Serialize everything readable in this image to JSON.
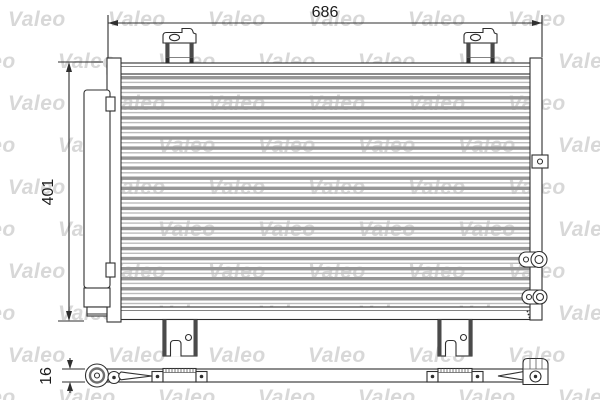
{
  "watermark": {
    "text": "Valeo",
    "color": "#d8d8d8"
  },
  "dimensions": {
    "width_mm": "686",
    "height_mm": "401",
    "depth_mm": "16"
  },
  "drawing": {
    "subject": "condenser-technical-drawing",
    "core_tube_rows": 23,
    "stroke_color": "#2f2f2f",
    "tube_band_color": "#979797",
    "tube_line_color": "#bcbcbc"
  }
}
